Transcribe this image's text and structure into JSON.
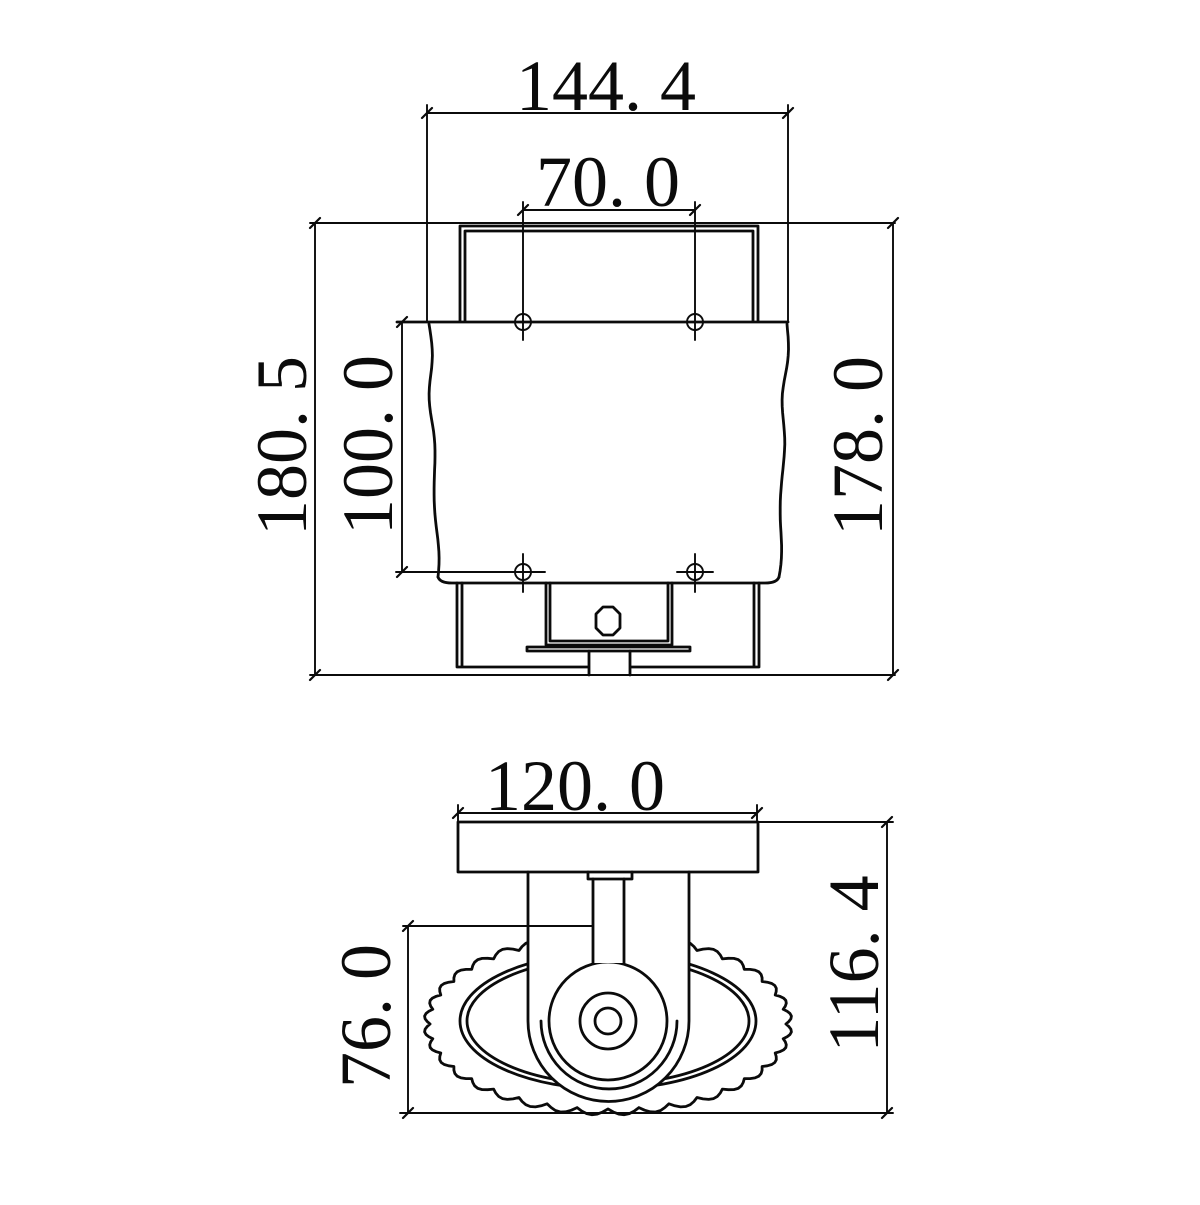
{
  "colors": {
    "line": "#0b0b0b",
    "background": "#ffffff"
  },
  "dims": {
    "front": {
      "overall_width": "144. 4",
      "hole_pitch_horizontal": "70. 0",
      "overall_height": "180. 5",
      "hole_pitch_vertical": "100. 0",
      "body_height": "178. 0"
    },
    "bottom": {
      "plate_width": "120. 0",
      "shade_depth": "76. 0",
      "overall_depth": "116. 4"
    }
  }
}
